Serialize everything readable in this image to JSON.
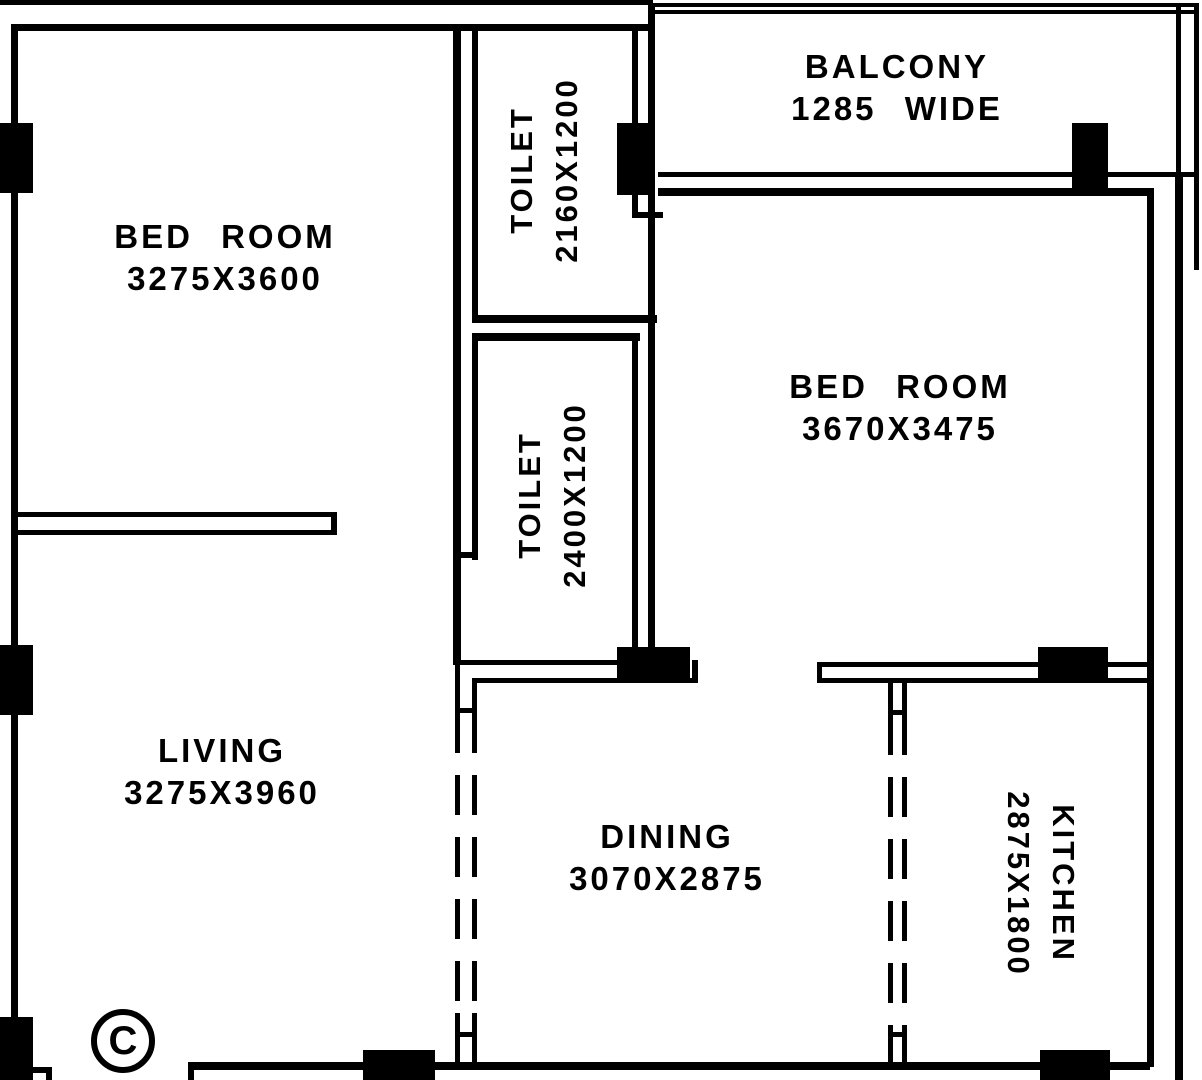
{
  "title": "2BHK apartment floor plan",
  "colors": {
    "wall": "#000000",
    "background": "#ffffff"
  },
  "rooms": {
    "bedroom1": {
      "name": "BED ROOM",
      "size": "3275X3600"
    },
    "toilet1": {
      "name": "TOILET",
      "size": "2160X1200"
    },
    "balcony": {
      "name": "BALCONY",
      "size": "1285 WIDE"
    },
    "bedroom2": {
      "name": "BED ROOM",
      "size": "3670X3475"
    },
    "toilet2": {
      "name": "TOILET",
      "size": "2400X1200"
    },
    "living": {
      "name": "LIVING",
      "size": "3275X3960"
    },
    "dining": {
      "name": "DINING",
      "size": "3070X2875"
    },
    "kitchen": {
      "name": "KITCHEN",
      "size": "2875X1800"
    }
  },
  "marker": {
    "label": "C"
  }
}
